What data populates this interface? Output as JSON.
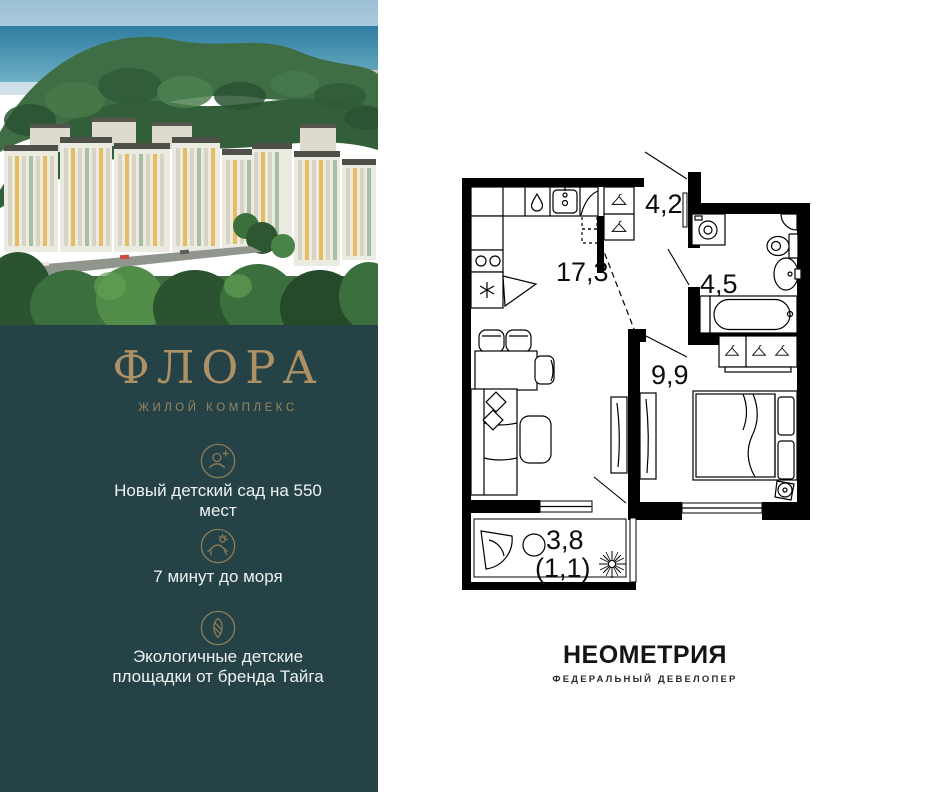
{
  "left_panel": {
    "logo": {
      "name": "ФЛОРА",
      "type": "ЖИЛОЙ КОМПЛЕКС"
    },
    "features": [
      {
        "icon": "person-add-icon",
        "text": "Новый детский сад на 550 мест"
      },
      {
        "icon": "beach-lounger-icon",
        "text": "7 минут до моря"
      },
      {
        "icon": "eco-leaf-icon",
        "text": "Экологичные детские площадки от бренда Тайга"
      }
    ]
  },
  "floorplan": {
    "rooms": {
      "kitchen_living": "17,3",
      "hallway": "4,2",
      "bathroom": "4,5",
      "bedroom": "9,9",
      "balcony": "3,8",
      "balcony_reduced": "(1,1)"
    },
    "fixtures": [
      "kitchen-counter",
      "kitchen-sink",
      "dishwasher",
      "stove",
      "fridge",
      "hall-wardrobe",
      "washing-machine",
      "toilet",
      "bathroom-sink",
      "bathtub",
      "bedroom-wardrobe",
      "bed",
      "tv-stand",
      "sofa",
      "dining-table",
      "coffee-table",
      "balcony-armchair",
      "balcony-table",
      "plant",
      "air-conditioner"
    ]
  },
  "developer": {
    "name": "НЕОМЕТРИЯ",
    "tagline": "ФЕДЕРАЛЬНЫЙ ДЕВЕЛОПЕР"
  },
  "colors": {
    "panel_teal": "#254346",
    "brand_gold": "#ae9065",
    "icon_gold": "#8d7b58",
    "text_white": "#eef2f1",
    "plan_black": "#000000",
    "photo_sky": "#9cc0d6",
    "photo_sea": "#2e7da2",
    "photo_forest": "#325f3a",
    "photo_facade": "#ecebe2",
    "photo_accent_yellow": "#e7bb61"
  }
}
